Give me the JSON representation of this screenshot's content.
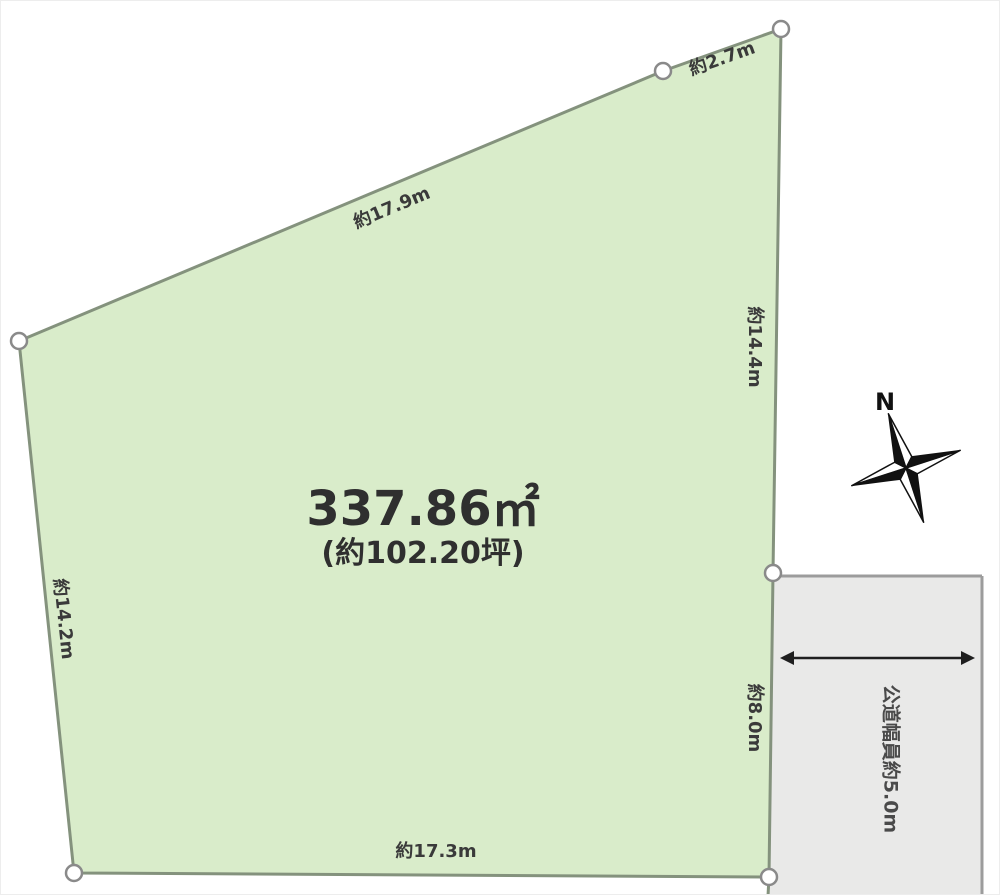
{
  "diagram": {
    "parcel": {
      "area_sqm": "337.86㎡",
      "area_tsubo": "(約102.20坪)"
    },
    "edges": {
      "top": "約17.9m",
      "top_right": "約2.7m",
      "right_upper": "約14.4m",
      "right_lower": "約8.0m",
      "bottom": "約17.3m",
      "left": "約14.2m"
    },
    "road": {
      "label": "公道幅員約5.0m"
    },
    "compass": {
      "north": "N"
    },
    "colors": {
      "parcel_fill": "#d9ecca",
      "parcel_stroke": "#84927d",
      "road_fill": "#e9e9e8",
      "road_stroke": "#9c9c9c",
      "label_text": "#3a3a3a",
      "area_text": "#2f2f2f"
    }
  }
}
